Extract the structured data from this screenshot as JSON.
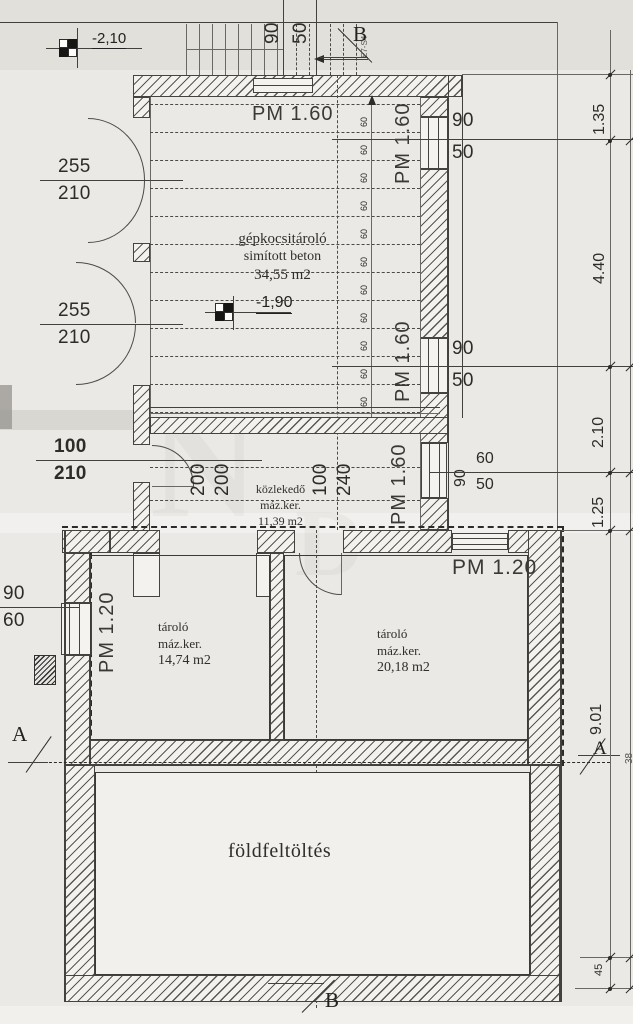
{
  "drawing": {
    "levels": {
      "upper": "-2,10",
      "garage": "-1,90"
    },
    "top": {
      "dim_w": "90",
      "dim_h": "50",
      "ref_code": "E7-S4"
    },
    "sections": {
      "a": "A",
      "b": "B"
    },
    "garage": {
      "pm": "PM 1.60",
      "name": "gépkocsitároló",
      "finish": "simított beton",
      "area": "34,55 m2",
      "step": "60"
    },
    "garage_windows": {
      "w1_a": "90",
      "w1_b": "50",
      "w2_a": "90",
      "w2_b": "50",
      "w3_a": "90",
      "w3_b": "60",
      "w3_c": "50"
    },
    "doors": {
      "d1_w": "255",
      "d1_h": "210",
      "d2_w": "255",
      "d2_h": "210",
      "d3_w": "100",
      "d3_h": "210"
    },
    "corridor": {
      "name": "közlekedő",
      "finish": "máz.ker.",
      "area": "11,39 m2",
      "o1_w": "200",
      "o1_h": "200",
      "o2_w": "100",
      "o2_h": "240",
      "pm": "PM 1.60"
    },
    "basement": {
      "pm_left": "PM 1.20",
      "pm_right": "PM 1.20",
      "win_a": "90",
      "win_b": "60",
      "room_left": {
        "name": "tároló",
        "finish": "máz.ker.",
        "area": "14,74 m2"
      },
      "room_right": {
        "name": "tároló",
        "finish": "máz.ker.",
        "area": "20,18 m2"
      },
      "fill_label": "földfeltöltés"
    },
    "dims_right": {
      "d1": "1.35",
      "d2": "4.40",
      "d3": "2.10",
      "d4": "1.25",
      "d5": "9.01",
      "d6": "45",
      "d7": "38"
    },
    "watermark": {
      "a": "N",
      "b": "D"
    }
  }
}
